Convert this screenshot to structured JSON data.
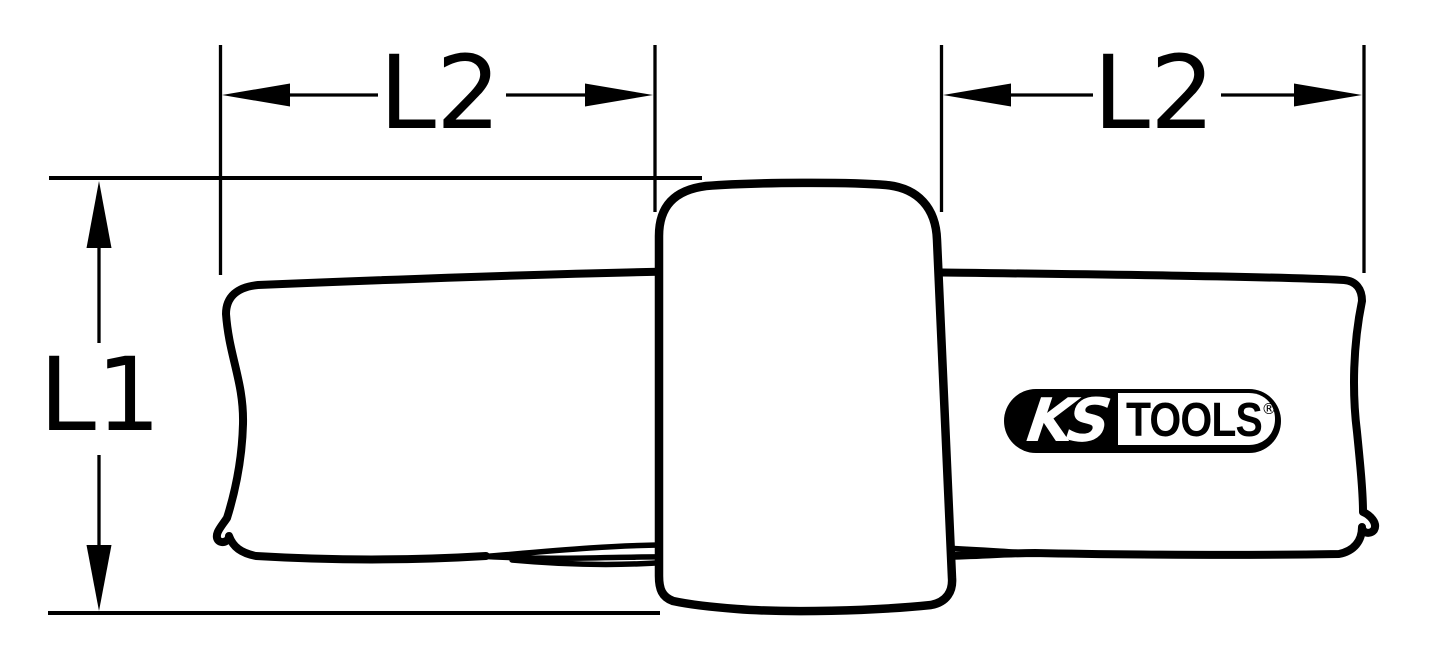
{
  "title": "KS Tools product dimensional drawing",
  "colors": {
    "background": "#ffffff",
    "line": "#000000"
  },
  "dimensions": {
    "l1_label": "L1",
    "l2_left_label": "L2",
    "l2_right_label": "L2"
  },
  "logo": {
    "ks_text": "KS",
    "tools_text": "TOOLS",
    "registered_mark": "®"
  }
}
